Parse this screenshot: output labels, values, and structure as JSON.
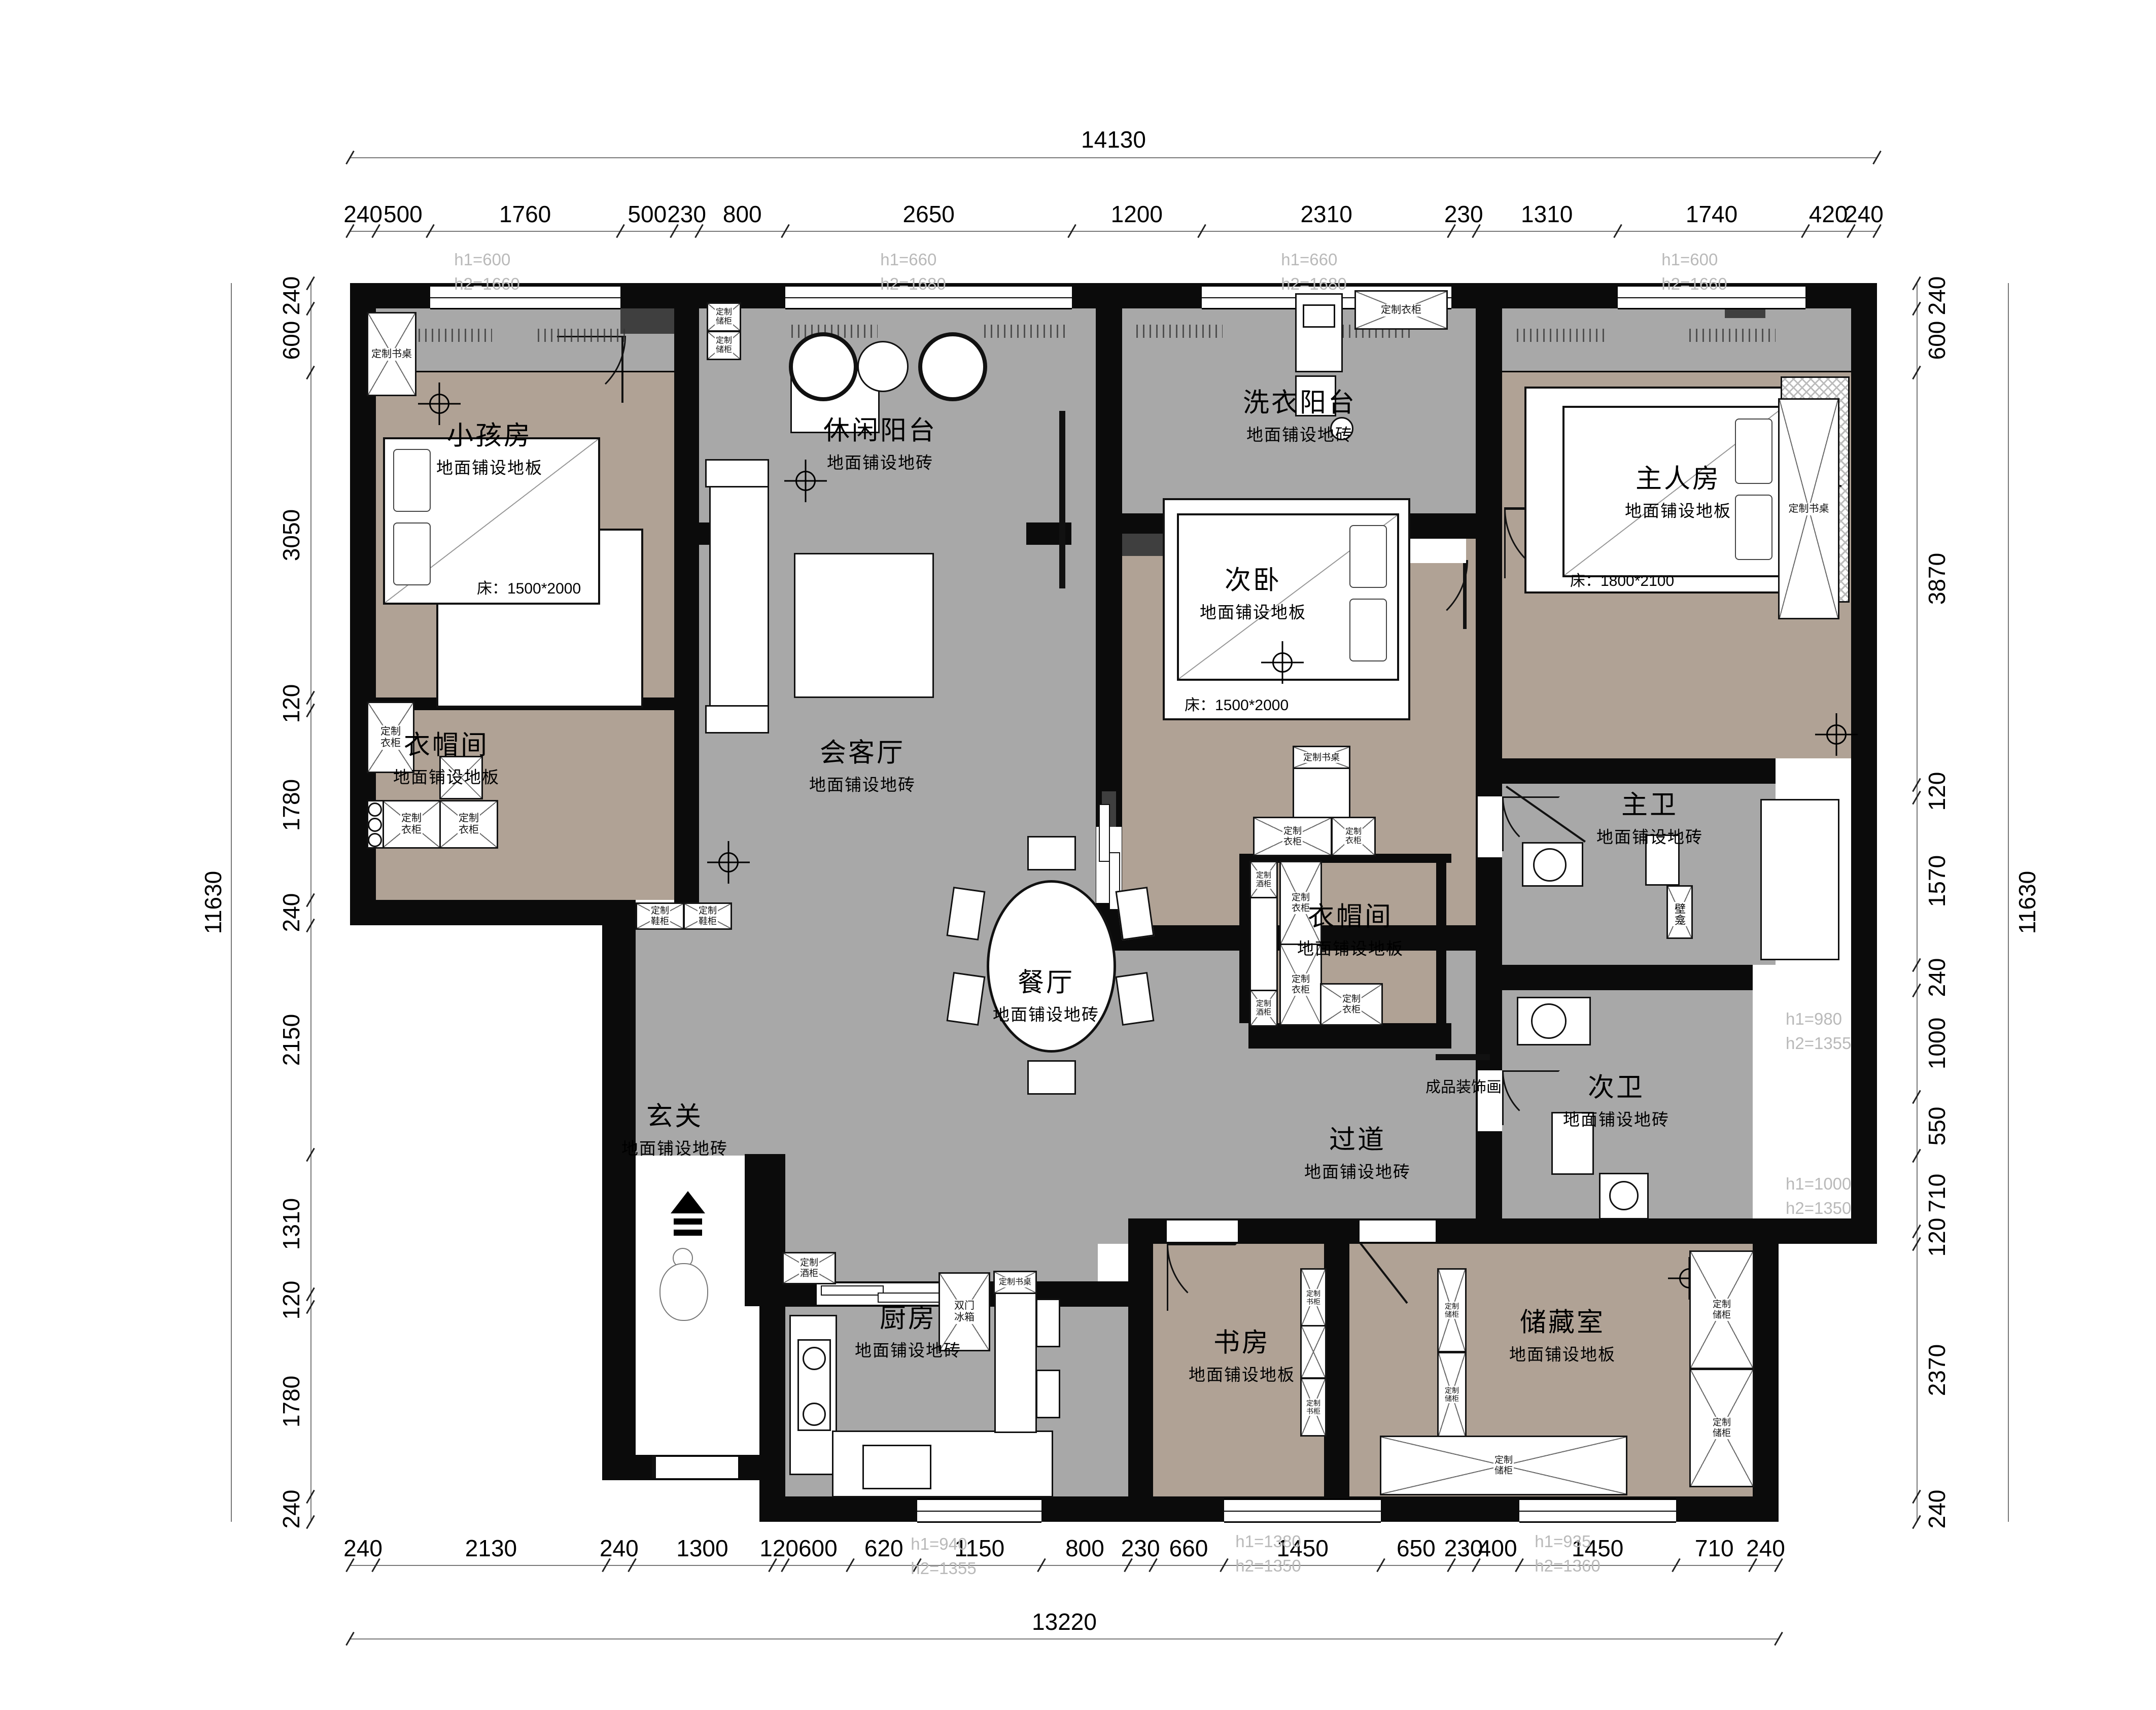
{
  "drawing": {
    "type": "residential floor plan"
  },
  "colors": {
    "wall": "#0b0b0b",
    "tile_floor": "#a8a8a8",
    "wood_floor": "#b0a295",
    "door_header": "#3f3f3f",
    "annotation": "#b9b9b9",
    "dimension_text": "#000000"
  },
  "dimensions": {
    "top": {
      "total": "14130",
      "segments": [
        "240",
        "500",
        "1760",
        "500",
        "230",
        "800",
        "2650",
        "1200",
        "2310",
        "230",
        "1310",
        "1740",
        "420",
        "240"
      ]
    },
    "bottom": {
      "total": "13220",
      "segments": [
        "240",
        "2130",
        "240",
        "1300",
        "120",
        "600",
        "620",
        "1150",
        "800",
        "230",
        "660",
        "1450",
        "650",
        "230",
        "400",
        "1450",
        "710",
        "240"
      ]
    },
    "left": {
      "total": "11630",
      "segments": [
        "240",
        "600",
        "3050",
        "120",
        "1780",
        "240",
        "2150",
        "1310",
        "120",
        "1780",
        "240"
      ]
    },
    "right": {
      "total": "11630",
      "segments": [
        "240",
        "600",
        "3870",
        "120",
        "1570",
        "240",
        "1000",
        "550",
        "710",
        "120",
        "2370",
        "240"
      ]
    }
  },
  "window_annotations": {
    "win_child": {
      "h1": "h1=600",
      "h2": "h2=1660"
    },
    "win_leisure": {
      "h1": "h1=660",
      "h2": "h2=1680"
    },
    "win_laundry": {
      "h1": "h1=660",
      "h2": "h2=1680"
    },
    "win_master": {
      "h1": "h1=600",
      "h2": "h2=1660"
    },
    "win_kitchen": {
      "h1": "h1=940",
      "h2": "h2=1355"
    },
    "win_study": {
      "h1": "h1=1380",
      "h2": "h2=1350"
    },
    "win_storage": {
      "h1": "h1=935",
      "h2": "h2=1360"
    },
    "win_bath1": {
      "h1": "h1=980",
      "h2": "h2=1355"
    },
    "win_bath2": {
      "h1": "h1=1000",
      "h2": "h2=1350"
    }
  },
  "rooms": {
    "child": {
      "name": "小孩房",
      "floor": "地面铺设地板",
      "note": "床：1500*2000"
    },
    "leisure": {
      "name": "休闲阳台",
      "floor": "地面铺设地砖"
    },
    "living": {
      "name": "会客厅",
      "floor": "地面铺设地砖"
    },
    "laundry": {
      "name": "洗衣阳台",
      "floor": "地面铺设地砖"
    },
    "bed2": {
      "name": "次卧",
      "floor": "地面铺设地板",
      "note": "床：1500*2000"
    },
    "master": {
      "name": "主人房",
      "floor": "地面铺设地板",
      "note": "床：1800*2100"
    },
    "cloak1": {
      "name": "衣帽间",
      "floor": "地面铺设地板"
    },
    "hall": {
      "name": "玄关",
      "floor": "地面铺设地砖"
    },
    "dining": {
      "name": "餐厅",
      "floor": "地面铺设地砖"
    },
    "cloak2": {
      "name": "衣帽间",
      "floor": "地面铺设地板"
    },
    "bath1": {
      "name": "主卫",
      "floor": "地面铺设地砖"
    },
    "bath2": {
      "name": "次卫",
      "floor": "地面铺设地砖"
    },
    "corridor": {
      "name": "过道",
      "floor": "地面铺设地砖"
    },
    "kitchen": {
      "name": "厨房",
      "floor": "地面铺设地砖"
    },
    "study": {
      "name": "书房",
      "floor": "地面铺设地板"
    },
    "storage": {
      "name": "储藏室",
      "floor": "地面铺设地板"
    }
  },
  "cabinets": {
    "c1": {
      "label": "定制书桌"
    },
    "c2": {
      "label": "定制\n储柜"
    },
    "c3": {
      "label": "定制\n储柜"
    },
    "c4": {
      "label": "定制\n衣柜"
    },
    "c5": {
      "label": "定制\n衣柜"
    },
    "c6": {
      "label": "定制\n衣柜"
    },
    "c7": {
      "label": "定制\n鞋柜"
    },
    "c8": {
      "label": "定制\n鞋柜"
    },
    "c9": {
      "label": "定制\n酒柜"
    },
    "c10": {
      "label": "定制\n酒柜"
    },
    "c11": {
      "label": "定制\n酒柜"
    },
    "c12": {
      "label": "定制\n衣柜"
    },
    "c13": {
      "label": "定制\n衣柜"
    },
    "c14": {
      "label": "定制\n衣柜"
    },
    "c15": {
      "label": "定制\n衣柜"
    },
    "c16": {
      "label": "定制\n衣柜"
    },
    "c17": {
      "label": "定制衣柜"
    },
    "c18": {
      "label": "定制书桌"
    },
    "c19": {
      "label": "定制书桌"
    },
    "c20": {
      "label": "定制书桌"
    },
    "c21": {
      "label": "定制\n书柜"
    },
    "c22": {
      "label": "定制\n书柜"
    },
    "c23": {
      "label": "定制\n储柜"
    },
    "c24": {
      "label": "定制\n储柜"
    },
    "c25": {
      "label": "定制\n储柜"
    },
    "c26": {
      "label": "定制\n储柜"
    },
    "c27": {
      "label": "定制\n储柜"
    }
  },
  "fixtures": {
    "fridge": {
      "label": "双门\n冰箱"
    },
    "niche": {
      "label": "壁龛"
    },
    "artwork": {
      "label": "成品装饰画"
    }
  }
}
